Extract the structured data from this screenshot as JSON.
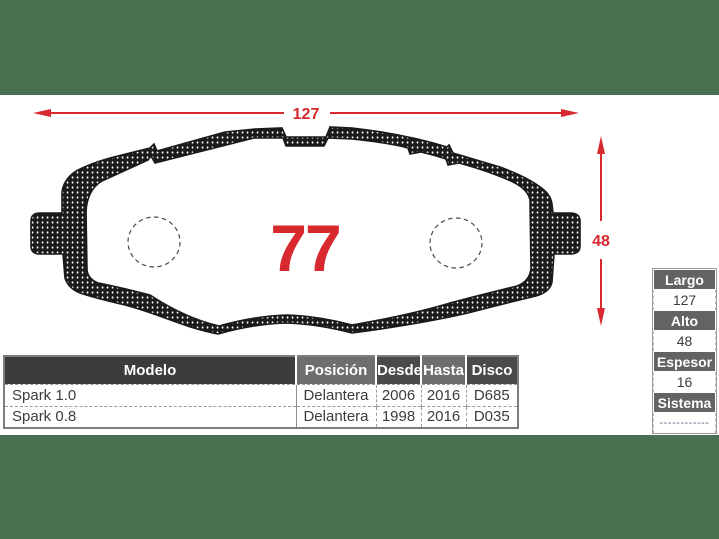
{
  "colors": {
    "background_green": "#4a7052",
    "accent_red": "#d8292e",
    "header_dark": "#3c3c3c",
    "header_mid": "#6e6e6e"
  },
  "diagram": {
    "part_number": "77",
    "width_dimension": "127",
    "height_dimension": "48"
  },
  "table": {
    "headers": [
      "Modelo",
      "Posición",
      "Desde",
      "Hasta",
      "Disco"
    ],
    "rows": [
      {
        "modelo": "Spark 1.0",
        "posicion": "Delantera",
        "desde": "2006",
        "hasta": "2016",
        "disco": "D685"
      },
      {
        "modelo": "Spark 0.8",
        "posicion": "Delantera",
        "desde": "1998",
        "hasta": "2016",
        "disco": "D035"
      }
    ]
  },
  "specs": [
    {
      "label": "Largo",
      "value": "127"
    },
    {
      "label": "Alto",
      "value": "48"
    },
    {
      "label": "Espesor",
      "value": "16"
    },
    {
      "label": "Sistema",
      "value": "------------"
    }
  ]
}
